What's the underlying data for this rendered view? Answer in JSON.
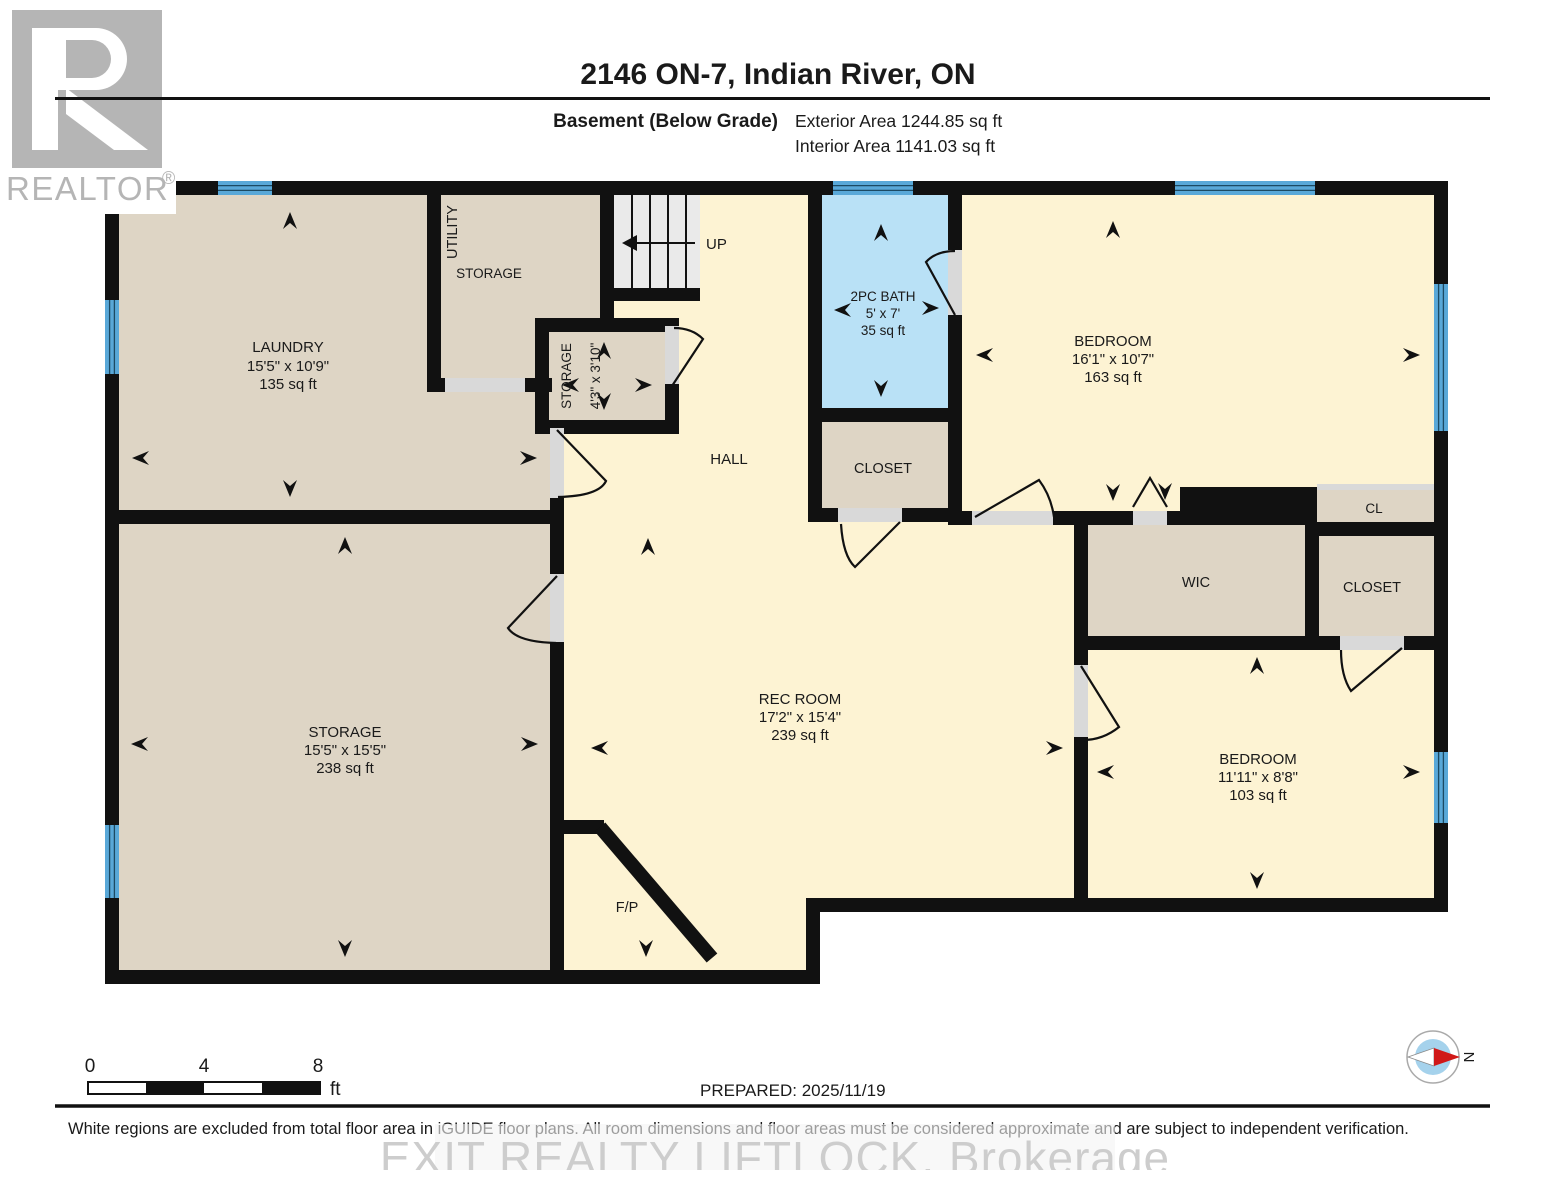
{
  "header": {
    "title": "2146 ON-7, Indian River, ON",
    "floor_label": "Basement (Below Grade)",
    "exterior_area": "Exterior Area 1244.85 sq ft",
    "interior_area": "Interior Area 1141.03 sq ft"
  },
  "logo": {
    "brand": "REALTOR",
    "registered": "®"
  },
  "rooms": {
    "laundry": {
      "name": "LAUNDRY",
      "dims": "15'5\" x 10'9\"",
      "area": "135 sq ft"
    },
    "utility": {
      "line1": "UTILITY",
      "line2": "STORAGE"
    },
    "storage_small": {
      "name": "STORAGE",
      "dims": "4'3\" x 3'10\""
    },
    "stairs": {
      "label": "UP"
    },
    "hall": {
      "name": "HALL"
    },
    "bath": {
      "name": "2PC BATH",
      "dims": "5' x 7'",
      "area": "35 sq ft"
    },
    "closet_bath": {
      "name": "CLOSET"
    },
    "bedroom_top": {
      "name": "BEDROOM",
      "dims": "16'1\" x 10'7\"",
      "area": "163 sq ft"
    },
    "cl": {
      "name": "CL"
    },
    "wic": {
      "name": "WIC"
    },
    "closet_right": {
      "name": "CLOSET"
    },
    "rec_room": {
      "name": "REC ROOM",
      "dims": "17'2\" x 15'4\"",
      "area": "239 sq ft"
    },
    "storage_big": {
      "name": "STORAGE",
      "dims": "15'5\" x 15'5\"",
      "area": "238 sq ft"
    },
    "bedroom_bottom": {
      "name": "BEDROOM",
      "dims": "11'11\" x 8'8\"",
      "area": "103 sq ft"
    },
    "fireplace": {
      "name": "F/P"
    }
  },
  "scale_bar": {
    "t0": "0",
    "t4": "4",
    "t8": "8",
    "unit": "ft"
  },
  "footer": {
    "prepared": "PREPARED: 2025/11/19",
    "compass_north": "N",
    "disclaimer": "White regions are excluded from total floor area in iGUIDE floor plans. All room dimensions and floor areas must be considered approximate and are subject to independent verification.",
    "watermark": "EXIT REALTY LIFTLOCK, Brokerage"
  },
  "colors": {
    "wall": "#111111",
    "room_warm": "#fdf3d3",
    "room_tan": "#ded5c5",
    "bath_blue": "#b9e1f6",
    "window_blue": "#59a8d8"
  }
}
